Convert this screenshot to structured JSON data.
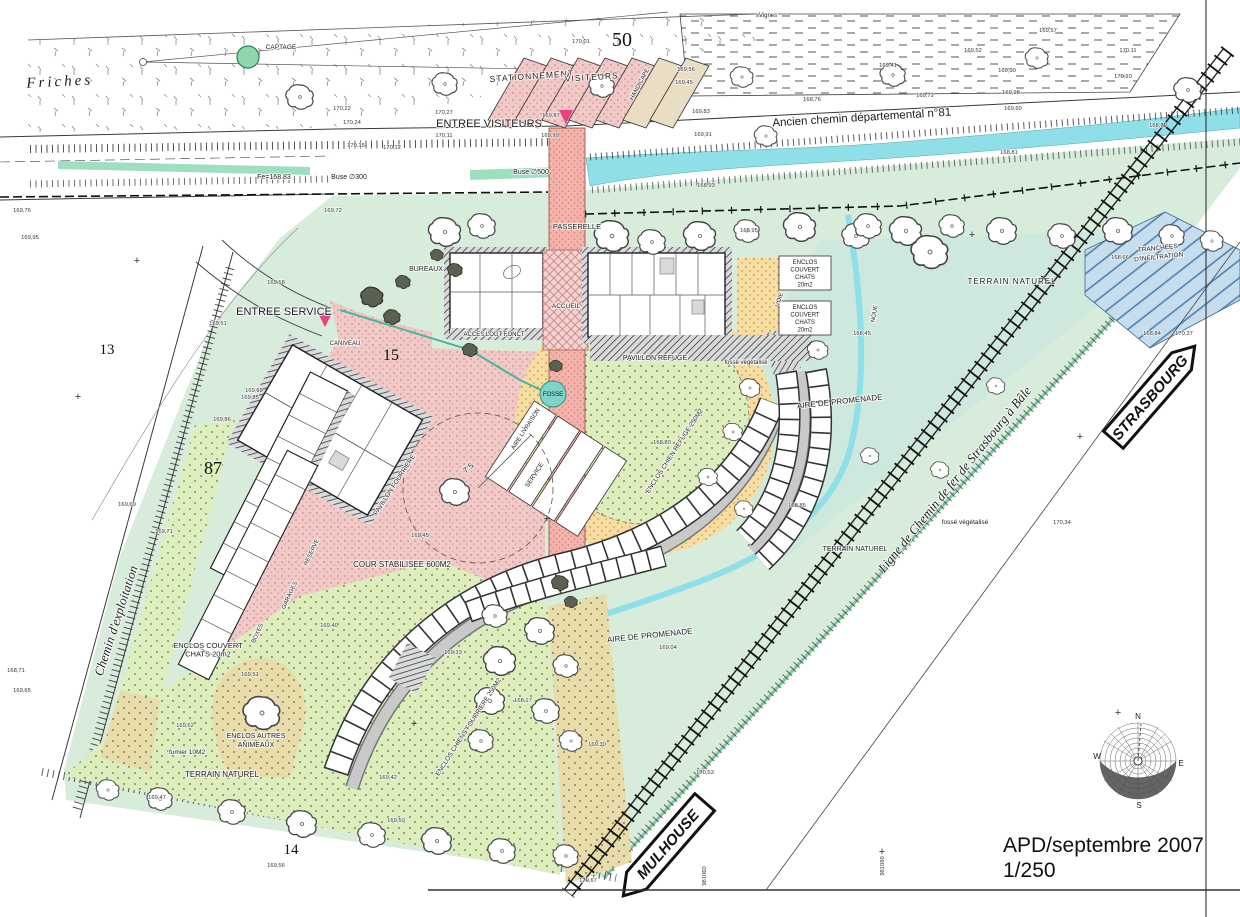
{
  "title_block": {
    "title": "APD/septembre 2007",
    "scale": "1/250"
  },
  "signs": {
    "strasbourg": "STRASBOURG",
    "mulhouse": "MULHOUSE"
  },
  "compass": {
    "n": "N",
    "e": "E",
    "s": "S",
    "w": "W"
  },
  "colors": {
    "site_green": "#d8ecdc",
    "terrain_teal": "#cfe8dd",
    "stream_cyan": "#8fdfe9",
    "ditch_green": "#9edfc0",
    "court_pink": "#f1c9c6",
    "walk_salmon": "#f3b4ad",
    "dots_green": "#ddeebc",
    "khaki": "#e8dcab",
    "orange": "#f6dda4",
    "infiltration_blue": "#c6ddee",
    "marker_pink": "#e8417e",
    "captage_green": "#8fd6ad"
  },
  "labels": {
    "friches": "Friches",
    "captage": "CAPTAGE",
    "vignes": "Vignes",
    "stationnement": "STATIONNEMENT",
    "visiteurs_stalls": "VISITEURS",
    "handicape": "HANDICAPE",
    "entree_visiteurs": "ENTREE VISITEURS",
    "ancien_chemin": "Ancien chemin départemental n°81",
    "passerelle": "PASSERELLE",
    "entree_service": "ENTREE SERVICE",
    "caniveau": "CANIVEAU",
    "bureaux": "BUREAUX",
    "acces_logt": "ACCES LOGT FONCT",
    "accueil": "ACCUEIL",
    "pavillon_refuge": "PAVILLON REFUGE",
    "enclos_chats_1": [
      "ENCLOS",
      "COUVERT",
      "CHATS",
      "20m2"
    ],
    "enclos_chats_2": [
      "ENCLOS",
      "COUVERT",
      "CHATS",
      "20m2"
    ],
    "enclos_chats_bl": [
      "ENCLOS COUVERT",
      "CHATS 20m2"
    ],
    "terrain_naturel_r": "TERRAIN NATUREL",
    "terrain_naturel_m": "TERRAIN NATUREL",
    "terrain_naturel_b": "TERRAIN NATUREL",
    "tranchees": [
      "TRANCHEES",
      "D'INFILTRATION"
    ],
    "noue": "NOUE",
    "voie": "VOIE",
    "aire_promenade_1": "AIRE DE PROMENADE",
    "aire_promenade_2": "AIRE DE PROMENADE",
    "enclos_chien_refuge": "ENCLOS CHIEN REFUGE 250M2",
    "enclos_chiens_fourriere": "ENCLOS CHIENS FOURRIERE 250M2",
    "fosse": "FOSSE",
    "aire_livraison": "AIRE LIVRAISON",
    "service_stall": "SERVICE",
    "pavillon_fourriere": "PAVILLON FOURRIERE",
    "cour_stabilisee": "COUR STABILISEE 600M2",
    "boxes": "BOXES",
    "garages": "GARAGES",
    "reserve": "RESERVE",
    "enclos_autres": [
      "ENCLOS AUTRES",
      "ANIMEAUX"
    ],
    "fumier": "fumier 10M2",
    "fosse_vegetalise_1": "fossé végétalisé",
    "fosse_vegetalise_2": "fossé végétalisé",
    "chemin_exploitation": "Chemin d'exploitation",
    "ligne_fer": "Ligne de Chemin de fer de Strasbourg à Bâle",
    "radius": "7.5",
    "buse300": "Buse ∅300",
    "buse500": "Buse ∅500",
    "fe": "Fe=168.83"
  },
  "parcels": [
    {
      "v": "50",
      "x": 622,
      "y": 46,
      "s": 20
    },
    {
      "v": "13",
      "x": 107,
      "y": 354,
      "s": 15
    },
    {
      "v": "15",
      "x": 391,
      "y": 360,
      "s": 16
    },
    {
      "v": "87",
      "x": 213,
      "y": 474,
      "s": 18
    },
    {
      "v": "14",
      "x": 291,
      "y": 854,
      "s": 15
    }
  ],
  "grid_coords": [
    {
      "v": "981060",
      "x": 706,
      "y": 876
    },
    {
      "v": "981080",
      "x": 884,
      "y": 866
    }
  ],
  "elevations": [
    {
      "v": "170,22",
      "x": 342,
      "y": 110
    },
    {
      "v": "170,24",
      "x": 352,
      "y": 124
    },
    {
      "v": "170,15",
      "x": 356,
      "y": 147
    },
    {
      "v": "170,12",
      "x": 392,
      "y": 149
    },
    {
      "v": "170,27",
      "x": 444,
      "y": 114
    },
    {
      "v": "170,11",
      "x": 444,
      "y": 137
    },
    {
      "v": "169,87",
      "x": 551,
      "y": 117
    },
    {
      "v": "169,99",
      "x": 550,
      "y": 137
    },
    {
      "v": "170,01",
      "x": 581,
      "y": 43
    },
    {
      "v": "169,83",
      "x": 701,
      "y": 113
    },
    {
      "v": "169,91",
      "x": 703,
      "y": 136
    },
    {
      "v": "169,56",
      "x": 686,
      "y": 71
    },
    {
      "v": "169,45",
      "x": 684,
      "y": 84
    },
    {
      "v": "169,72",
      "x": 925,
      "y": 97
    },
    {
      "v": "168,76",
      "x": 812,
      "y": 101
    },
    {
      "v": "169,41",
      "x": 888,
      "y": 67
    },
    {
      "v": "169,52",
      "x": 973,
      "y": 52
    },
    {
      "v": "169,57",
      "x": 1048,
      "y": 32
    },
    {
      "v": "169,90",
      "x": 1007,
      "y": 72
    },
    {
      "v": "170,11",
      "x": 1128,
      "y": 52
    },
    {
      "v": "170,10",
      "x": 1123,
      "y": 78
    },
    {
      "v": "169,98",
      "x": 1011,
      "y": 94
    },
    {
      "v": "169,60",
      "x": 1013,
      "y": 110
    },
    {
      "v": "168,79",
      "x": 1158,
      "y": 127
    },
    {
      "v": "168,81",
      "x": 1009,
      "y": 154
    },
    {
      "v": "168,93",
      "x": 706,
      "y": 187
    },
    {
      "v": "168,95",
      "x": 749,
      "y": 232
    },
    {
      "v": "169,72",
      "x": 333,
      "y": 212
    },
    {
      "v": "169,76",
      "x": 22,
      "y": 212
    },
    {
      "v": "169,95",
      "x": 30,
      "y": 239
    },
    {
      "v": "169,58",
      "x": 276,
      "y": 284
    },
    {
      "v": "169,51",
      "x": 218,
      "y": 325
    },
    {
      "v": "169,69",
      "x": 254,
      "y": 392
    },
    {
      "v": "169,85",
      "x": 250,
      "y": 399
    },
    {
      "v": "169,86",
      "x": 222,
      "y": 421
    },
    {
      "v": "169,69",
      "x": 127,
      "y": 506
    },
    {
      "v": "169,71",
      "x": 164,
      "y": 533
    },
    {
      "v": "168,71",
      "x": 16,
      "y": 672
    },
    {
      "v": "169,65",
      "x": 22,
      "y": 692
    },
    {
      "v": "168,45",
      "x": 862,
      "y": 335
    },
    {
      "v": "168,66",
      "x": 1120,
      "y": 259
    },
    {
      "v": "168,84",
      "x": 1152,
      "y": 335
    },
    {
      "v": "170,37",
      "x": 1184,
      "y": 335
    },
    {
      "v": "169,40",
      "x": 329,
      "y": 627
    },
    {
      "v": "169,45",
      "x": 420,
      "y": 537
    },
    {
      "v": "169,51",
      "x": 250,
      "y": 676
    },
    {
      "v": "169,62",
      "x": 185,
      "y": 727
    },
    {
      "v": "169,47",
      "x": 157,
      "y": 799
    },
    {
      "v": "169,42",
      "x": 388,
      "y": 779
    },
    {
      "v": "169,50",
      "x": 396,
      "y": 822
    },
    {
      "v": "168,80",
      "x": 662,
      "y": 444
    },
    {
      "v": "168,85",
      "x": 797,
      "y": 507
    },
    {
      "v": "169,33",
      "x": 453,
      "y": 654
    },
    {
      "v": "168,17",
      "x": 523,
      "y": 702
    },
    {
      "v": "169,04",
      "x": 668,
      "y": 649
    },
    {
      "v": "169,30",
      "x": 597,
      "y": 746
    },
    {
      "v": "170,67",
      "x": 588,
      "y": 882
    },
    {
      "v": "170,53",
      "x": 705,
      "y": 774
    },
    {
      "v": "169,56",
      "x": 276,
      "y": 867
    },
    {
      "v": "170,34",
      "x": 1062,
      "y": 524
    }
  ],
  "trees": [
    {
      "x": 445,
      "y": 232,
      "s": 1.4
    },
    {
      "x": 482,
      "y": 226,
      "s": 1.2
    },
    {
      "x": 612,
      "y": 236,
      "s": 1.5
    },
    {
      "x": 652,
      "y": 242,
      "s": 1.2
    },
    {
      "x": 700,
      "y": 236,
      "s": 1.4
    },
    {
      "x": 747,
      "y": 231,
      "s": 1.1
    },
    {
      "x": 800,
      "y": 227,
      "s": 1.4
    },
    {
      "x": 856,
      "y": 236,
      "s": 1.2
    },
    {
      "x": 906,
      "y": 231,
      "s": 1.4
    },
    {
      "x": 952,
      "y": 226,
      "s": 1.1
    },
    {
      "x": 1002,
      "y": 231,
      "s": 1.3
    },
    {
      "x": 1062,
      "y": 236,
      "s": 1.2
    },
    {
      "x": 1118,
      "y": 231,
      "s": 1.3
    },
    {
      "x": 1172,
      "y": 236,
      "s": 1.1
    },
    {
      "x": 1212,
      "y": 241,
      "s": 1.0
    },
    {
      "x": 300,
      "y": 97,
      "s": 1.2
    },
    {
      "x": 445,
      "y": 84,
      "s": 1.1
    },
    {
      "x": 602,
      "y": 86,
      "s": 1.1
    },
    {
      "x": 742,
      "y": 77,
      "s": 1.0
    },
    {
      "x": 893,
      "y": 75,
      "s": 1.1
    },
    {
      "x": 1037,
      "y": 58,
      "s": 1.0
    },
    {
      "x": 766,
      "y": 136,
      "s": 1.0
    },
    {
      "x": 1188,
      "y": 90,
      "s": 1.2
    },
    {
      "x": 930,
      "y": 252,
      "s": 1.6
    },
    {
      "x": 868,
      "y": 226,
      "s": 1.2
    },
    {
      "x": 996,
      "y": 386,
      "s": 0.8
    },
    {
      "x": 870,
      "y": 456,
      "s": 0.8
    },
    {
      "x": 940,
      "y": 470,
      "s": 0.8
    },
    {
      "x": 818,
      "y": 350,
      "s": 0.9
    },
    {
      "x": 455,
      "y": 492,
      "s": 1.3
    },
    {
      "x": 262,
      "y": 713,
      "s": 1.6
    },
    {
      "x": 750,
      "y": 388,
      "s": 0.9
    },
    {
      "x": 733,
      "y": 432,
      "s": 0.85
    },
    {
      "x": 708,
      "y": 477,
      "s": 0.85
    },
    {
      "x": 744,
      "y": 509,
      "s": 0.8
    },
    {
      "x": 495,
      "y": 616,
      "s": 1.1
    },
    {
      "x": 540,
      "y": 631,
      "s": 1.3
    },
    {
      "x": 500,
      "y": 661,
      "s": 1.4
    },
    {
      "x": 566,
      "y": 666,
      "s": 1.1
    },
    {
      "x": 490,
      "y": 701,
      "s": 1.3
    },
    {
      "x": 546,
      "y": 711,
      "s": 1.2
    },
    {
      "x": 481,
      "y": 741,
      "s": 1.1
    },
    {
      "x": 571,
      "y": 741,
      "s": 1.0
    },
    {
      "x": 108,
      "y": 790,
      "s": 1.0
    },
    {
      "x": 160,
      "y": 799,
      "s": 1.1
    },
    {
      "x": 232,
      "y": 812,
      "s": 1.2
    },
    {
      "x": 302,
      "y": 824,
      "s": 1.3
    },
    {
      "x": 372,
      "y": 835,
      "s": 1.2
    },
    {
      "x": 437,
      "y": 841,
      "s": 1.3
    },
    {
      "x": 502,
      "y": 851,
      "s": 1.2
    },
    {
      "x": 566,
      "y": 856,
      "s": 1.1
    },
    {
      "x": 372,
      "y": 297,
      "s": 1.2,
      "t": "b"
    },
    {
      "x": 392,
      "y": 317,
      "s": 0.9,
      "t": "b"
    },
    {
      "x": 403,
      "y": 282,
      "s": 0.8,
      "t": "b"
    },
    {
      "x": 560,
      "y": 583,
      "s": 0.9,
      "t": "b"
    },
    {
      "x": 571,
      "y": 602,
      "s": 0.7,
      "t": "b"
    },
    {
      "x": 556,
      "y": 366,
      "s": 0.7,
      "t": "b"
    },
    {
      "x": 470,
      "y": 350,
      "s": 0.8,
      "t": "b"
    },
    {
      "x": 455,
      "y": 270,
      "s": 0.8,
      "t": "b"
    },
    {
      "x": 437,
      "y": 255,
      "s": 0.7,
      "t": "b"
    }
  ],
  "crosses": [
    {
      "x": 137,
      "y": 264
    },
    {
      "x": 78,
      "y": 400
    },
    {
      "x": 972,
      "y": 238
    },
    {
      "x": 882,
      "y": 855
    },
    {
      "x": 1118,
      "y": 716
    },
    {
      "x": 414,
      "y": 727
    },
    {
      "x": 547,
      "y": 522
    },
    {
      "x": 1080,
      "y": 440
    }
  ]
}
